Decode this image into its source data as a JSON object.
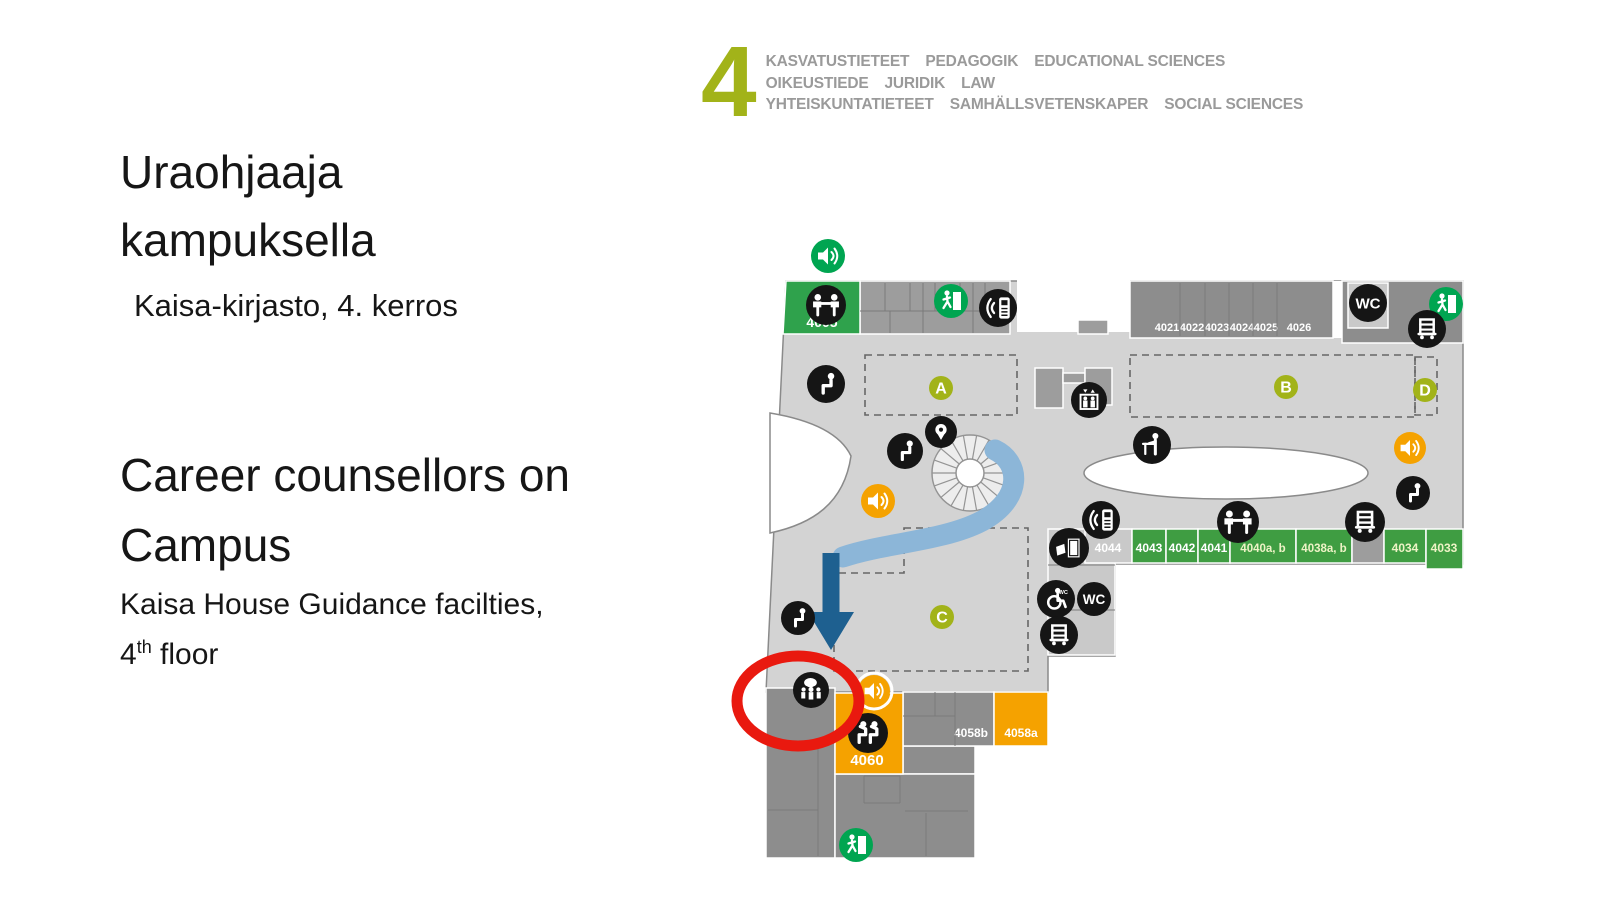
{
  "header": {
    "floor_number": "4",
    "lines": [
      {
        "segments": [
          "KASVATUSTIETEET",
          "PEDAGOGIK",
          "EDUCATIONAL SCIENCES"
        ]
      },
      {
        "segments": [
          "OIKEUSTIEDE",
          "JURIDIK",
          "LAW"
        ]
      },
      {
        "segments": [
          "YHTEISKUNTATIETEET",
          "SAMHÄLLSVETENSKAPER",
          "SOCIAL SCIENCES"
        ]
      }
    ]
  },
  "text_panel": {
    "title_fi": "Uraohjaaja kampuksella",
    "subtitle_fi": "Kaisa-kirjasto, 4. kerros",
    "title_en": "Career counsellors on Campus",
    "subtitle_en": {
      "prefix": "Kaisa House Guidance facilties, 4",
      "sup": "th",
      "suffix": " floor"
    }
  },
  "colors": {
    "accent_olive": "#a2b319",
    "header_text": "#9a9a9a",
    "floor_fill": "#d3d3d3",
    "floor_stroke": "#8a8a8a",
    "cell_gray": "#9d9d9d",
    "cell_light": "#c9c9c9",
    "room_dark": "#8d8d8d",
    "room_green": "#2fa24c",
    "row_green": "#3f9d42",
    "exit_green": "#00a551",
    "orange": "#f5a200",
    "icon_black": "#151515",
    "path_blue": "#8cb6d8",
    "arrow_blue": "#1e6090",
    "highlight_red": "#e9190f",
    "label_cream": "#eef3c6",
    "divider": "#7a7a7a"
  },
  "map": {
    "floor_polygon": "786,281 1463,281 1463,564 1115,564 1115,656 1048,656 1048,692 766,692",
    "leaf_path": "M 770 413 C 818 421 842 437 851 456 C 844 504 812 524 770 533 Z",
    "oval": {
      "cx": 1226,
      "cy": 473,
      "rx": 142,
      "ry": 26
    },
    "stair": {
      "cx": 970,
      "cy": 473,
      "ro": 38,
      "ri": 14,
      "spokes": 18
    },
    "blocks": [
      {
        "name": "top-cells-left",
        "rect": [
          860,
          281,
          150,
          53
        ],
        "fill": "cell_gray",
        "stroke": "#ffffff"
      },
      {
        "name": "top-notch-white",
        "rect": [
          1017,
          279,
          113,
          53
        ],
        "fill": "#ffffff",
        "stroke": "none"
      },
      {
        "name": "top-notch-step",
        "rect": [
          1078,
          320,
          30,
          14
        ],
        "fill": "cell_gray",
        "stroke": "#ffffff"
      },
      {
        "name": "rooms-4021-4026-band",
        "rect": [
          1130,
          281,
          203,
          57
        ],
        "fill": "room_dark",
        "stroke": "#ffffff"
      },
      {
        "name": "top-gap-white",
        "rect": [
          1333,
          281,
          9,
          57
        ],
        "fill": "#ffffff",
        "stroke": "none"
      },
      {
        "name": "top-right-band",
        "rect": [
          1342,
          281,
          121,
          62
        ],
        "fill": "room_dark",
        "stroke": "#ffffff"
      },
      {
        "name": "wc-room",
        "rect": [
          1348,
          283,
          40,
          45
        ],
        "fill": "cell_light",
        "stroke": "#ffffff"
      },
      {
        "name": "elevator-block-left",
        "rect": [
          1035,
          368,
          28,
          40
        ],
        "fill": "cell_gray",
        "stroke": "#ffffff"
      },
      {
        "name": "elevator-block-mid",
        "rect": [
          1063,
          373,
          22,
          10
        ],
        "fill": "cell_gray",
        "stroke": "#ffffff"
      },
      {
        "name": "elevator-block-right",
        "rect": [
          1085,
          368,
          27,
          37
        ],
        "fill": "cell_gray",
        "stroke": "#ffffff"
      },
      {
        "name": "utility-column",
        "rect": [
          1048,
          529,
          67,
          126
        ],
        "fill": "cell_light",
        "stroke": "#ffffff"
      },
      {
        "name": "lower-left-block",
        "rect": [
          766,
          688,
          69,
          170
        ],
        "fill": "room_dark",
        "stroke": "#ffffff"
      },
      {
        "name": "lower-mid-block",
        "rect": [
          903,
          746,
          72,
          28
        ],
        "fill": "room_dark",
        "stroke": "#ffffff"
      },
      {
        "name": "lower-bottom-block",
        "rect": [
          835,
          774,
          140,
          84
        ],
        "fill": "room_dark",
        "stroke": "#ffffff"
      }
    ],
    "rooms": [
      {
        "label": "4005",
        "poly": "786,281 860,281 860,334 783,334",
        "fill": "room_green",
        "lx": 822,
        "ly": 327,
        "fs": 14,
        "lc": "#ffffff"
      },
      {
        "label": "4044",
        "rect": [
          1085,
          529,
          47,
          34
        ],
        "fill": "cell_light",
        "lx": 1108,
        "ly": 552,
        "fs": 12,
        "lc": "#ffffff"
      },
      {
        "label": "4043",
        "rect": [
          1132,
          529,
          34,
          34
        ],
        "fill": "row_green",
        "lx": 1149,
        "ly": 552,
        "fs": 12,
        "lc": "#ffffff"
      },
      {
        "label": "4042",
        "rect": [
          1166,
          529,
          32,
          34
        ],
        "fill": "row_green",
        "lx": 1182,
        "ly": 552,
        "fs": 12,
        "lc": "#ffffff"
      },
      {
        "label": "4041",
        "rect": [
          1198,
          529,
          32,
          34
        ],
        "fill": "row_green",
        "lx": 1214,
        "ly": 552,
        "fs": 12,
        "lc": "#ffffff"
      },
      {
        "label": "4040a, b",
        "rect": [
          1230,
          529,
          66,
          34
        ],
        "fill": "row_green",
        "lx": 1263,
        "ly": 552,
        "fs": 11.5,
        "lc": "#eef3c6"
      },
      {
        "label": "4038a, b",
        "rect": [
          1296,
          529,
          56,
          34
        ],
        "fill": "row_green",
        "lx": 1324,
        "ly": 552,
        "fs": 11.5,
        "lc": "#eef3c6"
      },
      {
        "label": "",
        "rect": [
          1352,
          529,
          32,
          34
        ],
        "fill": "cell_gray",
        "lx": 0,
        "ly": 0,
        "fs": 0,
        "lc": "#ffffff"
      },
      {
        "label": "4034",
        "rect": [
          1384,
          529,
          42,
          34
        ],
        "fill": "row_green",
        "lx": 1405,
        "ly": 552,
        "fs": 12,
        "lc": "#eef3c6"
      },
      {
        "label": "4033",
        "rect": [
          1426,
          529,
          37,
          40
        ],
        "fill": "row_green",
        "lx": 1444,
        "ly": 552,
        "fs": 12,
        "lc": "#eef3c6"
      },
      {
        "label": "4058b",
        "rect": [
          903,
          692,
          91,
          54
        ],
        "fill": "room_dark",
        "lx": 971,
        "ly": 737,
        "fs": 12,
        "lc": "#ffffff"
      },
      {
        "label": "4058a",
        "rect": [
          994,
          692,
          54,
          54
        ],
        "fill": "orange",
        "lx": 1021,
        "ly": 737,
        "fs": 12,
        "lc": "#ffffff"
      },
      {
        "label": "4060",
        "rect": [
          835,
          693,
          68,
          81
        ],
        "fill": "orange",
        "lx": 867,
        "ly": 765,
        "fs": 15,
        "lc": "#ffffff"
      }
    ],
    "band_labels": [
      {
        "text": "4021",
        "x": 1167,
        "y": 331
      },
      {
        "text": "4022",
        "x": 1192,
        "y": 331
      },
      {
        "text": "4023",
        "x": 1217,
        "y": 331
      },
      {
        "text": "4024",
        "x": 1242,
        "y": 331
      },
      {
        "text": "4025",
        "x": 1266,
        "y": 331
      },
      {
        "text": "4026",
        "x": 1299,
        "y": 331
      }
    ],
    "divider_lines": [
      [
        885,
        283,
        885,
        311
      ],
      [
        910,
        283,
        910,
        311
      ],
      [
        935,
        283,
        935,
        311
      ],
      [
        960,
        283,
        960,
        311
      ],
      [
        985,
        283,
        985,
        311
      ],
      [
        860,
        311,
        1010,
        311
      ],
      [
        890,
        311,
        890,
        333
      ],
      [
        923,
        283,
        923,
        333
      ],
      [
        973,
        283,
        973,
        333
      ],
      [
        1180,
        283,
        1180,
        336
      ],
      [
        1205,
        283,
        1205,
        336
      ],
      [
        1229,
        283,
        1229,
        336
      ],
      [
        1253,
        283,
        1253,
        336
      ],
      [
        1277,
        283,
        1277,
        336
      ],
      [
        1048,
        565,
        1115,
        565
      ],
      [
        1048,
        610,
        1115,
        610
      ],
      [
        818,
        748,
        818,
        856
      ],
      [
        768,
        810,
        818,
        810
      ],
      [
        905,
        811,
        968,
        811
      ],
      [
        864,
        776,
        900,
        776
      ],
      [
        864,
        776,
        864,
        803
      ],
      [
        900,
        776,
        900,
        803
      ],
      [
        864,
        803,
        900,
        803
      ],
      [
        926,
        813,
        926,
        856
      ],
      [
        935,
        692,
        935,
        716
      ],
      [
        903,
        716,
        955,
        716
      ],
      [
        955,
        692,
        955,
        746
      ]
    ],
    "zones": [
      {
        "label": "A",
        "rect": [
          865,
          355,
          152,
          60
        ],
        "circle": [
          941,
          388
        ]
      },
      {
        "label": "B",
        "rect": [
          1130,
          355,
          285,
          62
        ],
        "circle": [
          1286,
          387
        ]
      },
      {
        "label": "D",
        "rect": [
          1415,
          357,
          22,
          58
        ],
        "circle": [
          1425,
          390
        ]
      },
      {
        "label": "C",
        "poly": "904,528 1028,528 1028,671 834,671 834,573 904,573",
        "circle": [
          942,
          617
        ]
      }
    ],
    "route": {
      "band": "M 995 450 C 1020 462 1024 498 982 521 C 944 541 884 543 843 557",
      "shaft": "M 831 553 L 831 615",
      "head": "808,612 854,612 831,650"
    },
    "icons": [
      {
        "type": "speaker",
        "variant": "green",
        "x": 828,
        "y": 256,
        "r": 17
      },
      {
        "type": "group-table",
        "x": 826,
        "y": 305,
        "r": 20
      },
      {
        "type": "exit",
        "x": 951,
        "y": 301,
        "r": 17
      },
      {
        "type": "phone",
        "x": 998,
        "y": 308,
        "r": 19
      },
      {
        "type": "seated",
        "x": 826,
        "y": 384,
        "r": 19
      },
      {
        "type": "pin",
        "x": 941,
        "y": 432,
        "r": 16
      },
      {
        "type": "seated",
        "x": 905,
        "y": 451,
        "r": 18
      },
      {
        "type": "speaker",
        "variant": "orange",
        "x": 878,
        "y": 501,
        "r": 17
      },
      {
        "type": "elevator",
        "x": 1089,
        "y": 400,
        "r": 18
      },
      {
        "type": "standing-desk",
        "x": 1152,
        "y": 445,
        "r": 19
      },
      {
        "type": "phone",
        "x": 1101,
        "y": 520,
        "r": 19
      },
      {
        "type": "copier",
        "x": 1069,
        "y": 548,
        "r": 20
      },
      {
        "type": "wheelchair",
        "x": 1056,
        "y": 599,
        "r": 19
      },
      {
        "type": "wc",
        "x": 1094,
        "y": 599,
        "r": 17
      },
      {
        "type": "cart",
        "x": 1059,
        "y": 635,
        "r": 19
      },
      {
        "type": "group-table",
        "x": 1238,
        "y": 522,
        "r": 21
      },
      {
        "type": "cart",
        "x": 1365,
        "y": 522,
        "r": 20
      },
      {
        "type": "wc",
        "x": 1368,
        "y": 303,
        "r": 19
      },
      {
        "type": "exit",
        "x": 1446,
        "y": 304,
        "r": 17
      },
      {
        "type": "cart",
        "x": 1427,
        "y": 329,
        "r": 19
      },
      {
        "type": "speaker",
        "variant": "orange",
        "x": 1410,
        "y": 448,
        "r": 16
      },
      {
        "type": "seated",
        "x": 1413,
        "y": 493,
        "r": 17
      },
      {
        "type": "seated",
        "x": 798,
        "y": 618,
        "r": 17
      },
      {
        "type": "counselling",
        "x": 811,
        "y": 690,
        "r": 18
      },
      {
        "type": "speaker",
        "variant": "orange_ring",
        "x": 874,
        "y": 691,
        "r": 16
      },
      {
        "type": "audience",
        "x": 868,
        "y": 733,
        "r": 20
      },
      {
        "type": "exit",
        "x": 856,
        "y": 845,
        "r": 17
      }
    ],
    "highlight": {
      "cx": 798,
      "cy": 701,
      "rx": 61,
      "ry": 45,
      "stroke_width": 11
    }
  }
}
